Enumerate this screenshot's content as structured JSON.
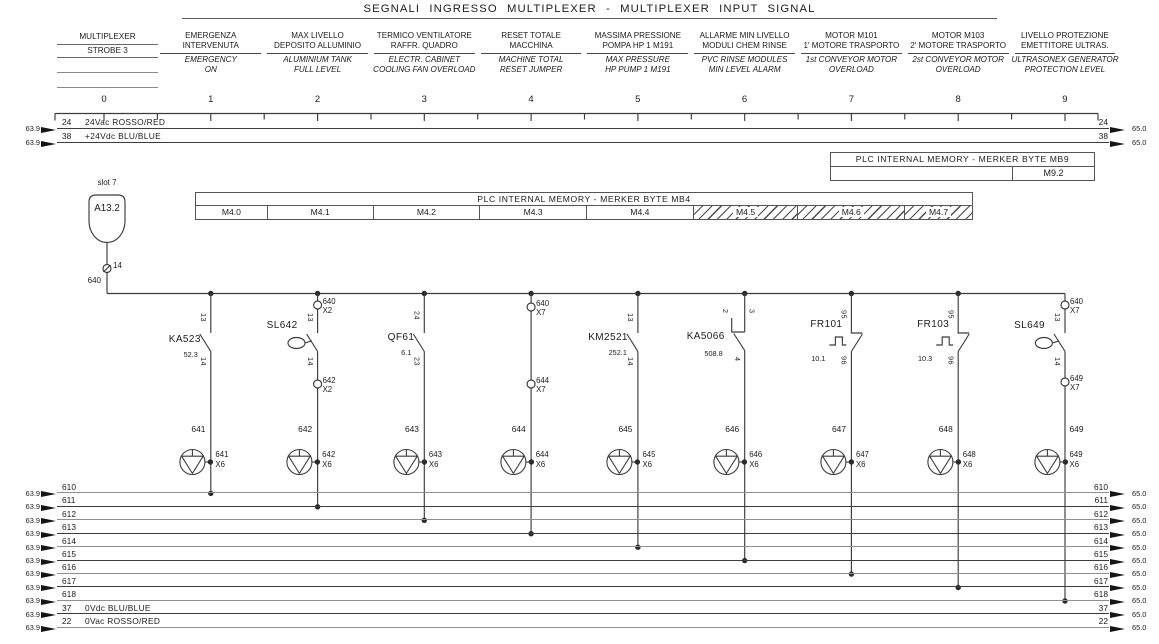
{
  "title": "SEGNALI INGRESSO MULTIPLEXER  -  MULTIPLEXER INPUT SIGNAL",
  "mux_block": {
    "line1": "MULTIPLEXER",
    "line2": "STROBE 3"
  },
  "columns": [
    {
      "it1": "EMERGENZA",
      "it2": "INTERVENUTA",
      "en1": "EMERGENCY",
      "en2": "ON"
    },
    {
      "it1": "MAX LIVELLO",
      "it2": "DEPOSITO ALLUMINIO",
      "en1": "ALUMINIUM TANK",
      "en2": "FULL LEVEL"
    },
    {
      "it1": "TERMICO VENTILATORE",
      "it2": "RAFFR. QUADRO",
      "en1": "ELECTR. CABINET",
      "en2": "COOLING FAN OVERLOAD"
    },
    {
      "it1": "RESET TOTALE",
      "it2": "MACCHINA",
      "en1": "MACHINE TOTAL",
      "en2": "RESET JUMPER"
    },
    {
      "it1": "MASSIMA PRESSIONE",
      "it2": "POMPA HP 1 M191",
      "en1": "MAX PRESSURE",
      "en2": "HP PUMP 1 M191"
    },
    {
      "it1": "ALLARME MIN LIVELLO",
      "it2": "MODULI CHEM RINSE",
      "en1": "PVC RINSE MODULES",
      "en2": "MIN LEVEL ALARM"
    },
    {
      "it1": "MOTOR M101",
      "it2": "1' MOTORE TRASPORTO",
      "en1": "1st CONVEYOR MOTOR",
      "en2": "OVERLOAD"
    },
    {
      "it1": "MOTOR M103",
      "it2": "2' MOTORE TRASPORTO",
      "en1": "2st CONVEYOR MOTOR",
      "en2": "OVERLOAD"
    },
    {
      "it1": "LIVELLO PROTEZIONE",
      "it2": "EMETTITORE ULTRAS.",
      "en1": "ULTRASONEX GENERATOR",
      "en2": "PROTECTION LEVEL"
    }
  ],
  "ruler_numbers": [
    "0",
    "1",
    "2",
    "3",
    "4",
    "5",
    "6",
    "7",
    "8",
    "9"
  ],
  "top_rails": [
    {
      "src": "63.9",
      "num": "24",
      "name": "24Vac ROSSO/RED",
      "num_r": "24",
      "dst": "65.0"
    },
    {
      "src": "63.9",
      "num": "38",
      "name": "+24Vdc BLU/BLUE",
      "num_r": "38",
      "dst": "65.0"
    }
  ],
  "mb9": {
    "header": "PLC INTERNAL MEMORY  -  MERKER BYTE MB9",
    "value": "M9.2"
  },
  "plc_module": {
    "slot": "slot 7",
    "name": "A13.2",
    "terminal": "14",
    "wire": "640"
  },
  "mb4": {
    "header": "PLC INTERNAL MEMORY  -  MERKER BYTE MB4",
    "cells": [
      "M4.0",
      "M4.1",
      "M4.2",
      "M4.3",
      "M4.4",
      "M4.5",
      "M4.6",
      "M4.7"
    ]
  },
  "components": [
    {
      "name": "KA523",
      "ref": "52.3",
      "t_top": "13",
      "t_bot": "14"
    },
    {
      "name": "SL642",
      "t_top": "13",
      "t_bot": "14",
      "top_term": {
        "w": "640",
        "b": "X2"
      },
      "bot_term": {
        "w": "642",
        "b": "X2"
      }
    },
    {
      "name": "QF61",
      "ref": "6.1",
      "t_top": "24",
      "t_bot": "23"
    },
    {
      "top_term": {
        "w": "640",
        "b": "X7"
      },
      "bot_term": {
        "w": "644",
        "b": "X7"
      }
    },
    {
      "name": "KM2521",
      "ref": "252.1",
      "t_top": "13",
      "t_bot": "14"
    },
    {
      "name": "KA5066",
      "ref": "508.8",
      "t_top": "2",
      "t_top2": "3",
      "t_bot": "4"
    },
    {
      "name": "FR101",
      "ref": "10.1",
      "t_top": "95",
      "t_bot": "96"
    },
    {
      "name": "FR103",
      "ref": "10.3",
      "t_top": "95",
      "t_bot": "96"
    },
    {
      "name": "SL649",
      "t_top": "13",
      "t_bot": "14",
      "top_term": {
        "w": "640",
        "b": "X7"
      },
      "bot_term": {
        "w": "649",
        "b": "X7"
      }
    }
  ],
  "outputs": [
    {
      "wire": "641",
      "term": "641",
      "block": "X6"
    },
    {
      "wire": "642",
      "term": "642",
      "block": "X6"
    },
    {
      "wire": "643",
      "term": "643",
      "block": "X6"
    },
    {
      "wire": "644",
      "term": "644",
      "block": "X6"
    },
    {
      "wire": "645",
      "term": "645",
      "block": "X6"
    },
    {
      "wire": "646",
      "term": "646",
      "block": "X6"
    },
    {
      "wire": "647",
      "term": "647",
      "block": "X6"
    },
    {
      "wire": "648",
      "term": "648",
      "block": "X6"
    },
    {
      "wire": "649",
      "term": "649",
      "block": "X6"
    }
  ],
  "bottom_rails": [
    {
      "src": "63.9",
      "num": "610",
      "name": "",
      "num_r": "610",
      "dst": "65.0"
    },
    {
      "src": "63.9",
      "num": "611",
      "name": "",
      "num_r": "611",
      "dst": "65.0"
    },
    {
      "src": "63.9",
      "num": "612",
      "name": "",
      "num_r": "612",
      "dst": "65.0"
    },
    {
      "src": "63.9",
      "num": "613",
      "name": "",
      "num_r": "613",
      "dst": "65.0"
    },
    {
      "src": "63.9",
      "num": "614",
      "name": "",
      "num_r": "614",
      "dst": "65.0"
    },
    {
      "src": "63.9",
      "num": "615",
      "name": "",
      "num_r": "615",
      "dst": "65.0"
    },
    {
      "src": "63.9",
      "num": "616",
      "name": "",
      "num_r": "616",
      "dst": "65.0"
    },
    {
      "src": "63.9",
      "num": "617",
      "name": "",
      "num_r": "617",
      "dst": "65.0"
    },
    {
      "src": "63.9",
      "num": "618",
      "name": "",
      "num_r": "618",
      "dst": "65.0"
    },
    {
      "src": "63.9",
      "num": "37",
      "name": "0Vdc BLU/BLUE",
      "num_r": "37",
      "dst": "65.0"
    },
    {
      "src": "63.9",
      "num": "22",
      "name": "0Vac ROSSO/RED",
      "num_r": "22",
      "dst": "65.0"
    }
  ]
}
